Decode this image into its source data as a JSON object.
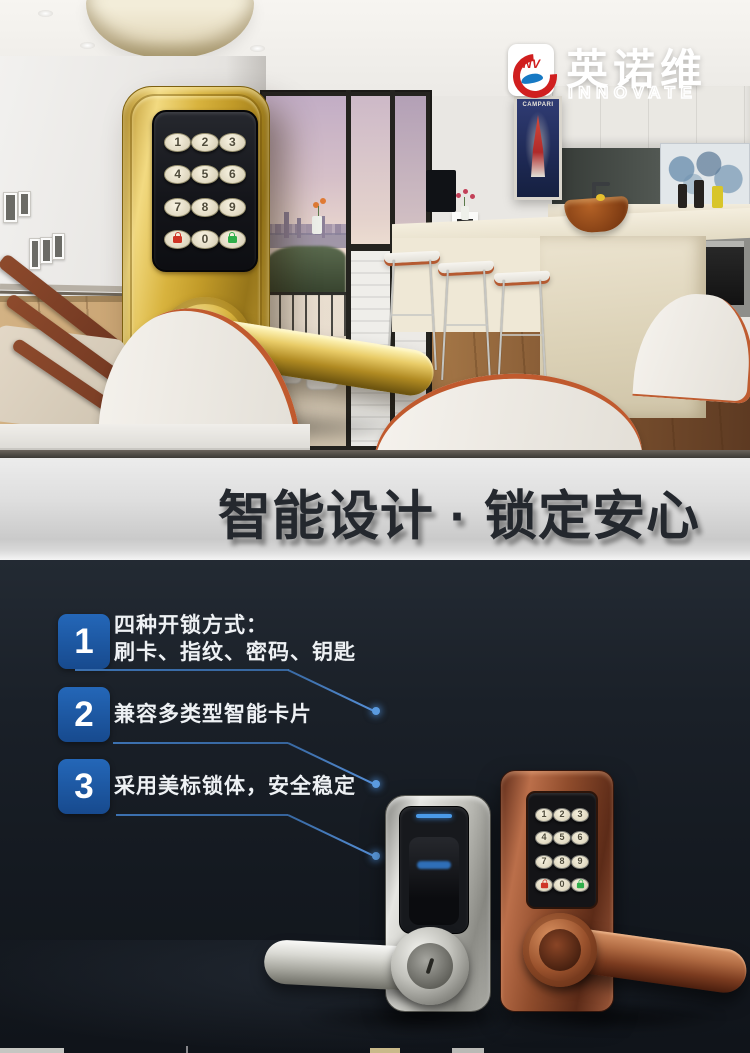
{
  "brand": {
    "emblem": "INV",
    "name_cn": "英诺维",
    "name_en": "INNOVATE",
    "colors": {
      "red": "#d01f1f",
      "blue": "#1779c4"
    }
  },
  "hero": {
    "poster_text": "CAMPARI"
  },
  "keypad_rows": [
    [
      "1",
      "2",
      "3"
    ],
    [
      "4",
      "5",
      "6"
    ],
    [
      "7",
      "8",
      "9"
    ],
    [
      "lock-icon",
      "0",
      "unlock-icon"
    ]
  ],
  "banner": {
    "title": "智能设计 · 锁定安心",
    "bg": "#d9d9d9",
    "text_color": "#24282e"
  },
  "features": {
    "badge_color": "#1e58a2",
    "line_color": "#3e76b9",
    "items": [
      {
        "number": "1",
        "lines": [
          "四种开锁方式：",
          "刷卡、指纹、密码、钥匙"
        ]
      },
      {
        "number": "2",
        "lines": [
          "兼容多类型智能卡片"
        ]
      },
      {
        "number": "3",
        "lines": [
          "采用美标锁体，安全稳定"
        ]
      }
    ]
  },
  "products": {
    "gold_lock": {
      "finish": "gold",
      "status_colors": {
        "lock": "#cf3526",
        "unlock": "#2fae4a"
      }
    },
    "silver_lock": {
      "finish": "silver",
      "led_color": "#4a9ae8"
    },
    "copper_lock": {
      "finish": "copper",
      "status_colors": {
        "lock": "#cf3526",
        "unlock": "#2fae4a"
      }
    }
  }
}
